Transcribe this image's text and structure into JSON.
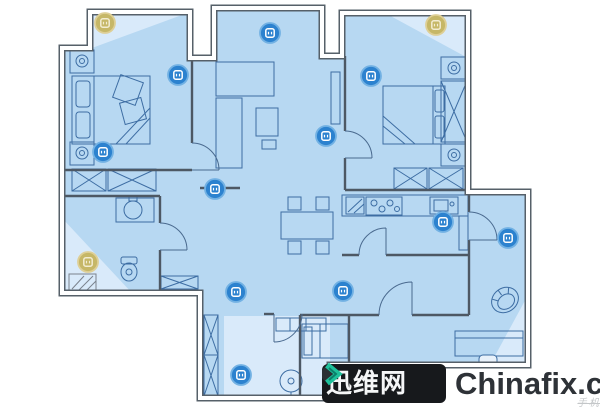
{
  "watermark": {
    "logo_text": "迅维网",
    "domain": "Chinafix.com",
    "tagline": "手机维修技改",
    "colors": {
      "box": "#17191c",
      "chevron": "#1ec19b",
      "chevron_dark": "#2a2f33",
      "logo_text_color": "#f5f6f7",
      "domain_text_color": "#2e3237"
    }
  },
  "floorplan": {
    "colors": {
      "floor_fill": "#b7d8f2",
      "floor_light_fill": "#d9eafa",
      "outer_wall": "#566069",
      "interior_wall": "#4d5864",
      "furniture_line": "#3d6da3",
      "marker_blue": "#2c82cf",
      "marker_blue_ring": "#72b1e3",
      "marker_yellow": "#c6b767",
      "marker_yellow_ring": "#decf96"
    },
    "rooms": [
      "balcony",
      "bedroom-1",
      "living-room",
      "bedroom-2",
      "bathroom",
      "kitchen",
      "dining-area",
      "hallway",
      "entry",
      "study"
    ],
    "markers": {
      "blue": {
        "icon": "smart-device-marker-icon",
        "fill": "#2c82cf",
        "ring": "#72b1e3",
        "glyph": "#ffffff",
        "items": [
          {
            "x": 178,
            "y": 75,
            "area": "bedroom-1"
          },
          {
            "x": 103,
            "y": 152,
            "area": "bedroom-1"
          },
          {
            "x": 270,
            "y": 33,
            "area": "living-room-bay"
          },
          {
            "x": 326,
            "y": 136,
            "area": "living-room"
          },
          {
            "x": 215,
            "y": 189,
            "area": "hallway"
          },
          {
            "x": 371,
            "y": 76,
            "area": "bedroom-2"
          },
          {
            "x": 443,
            "y": 222,
            "area": "kitchen"
          },
          {
            "x": 508,
            "y": 238,
            "area": "study"
          },
          {
            "x": 343,
            "y": 291,
            "area": "hallway"
          },
          {
            "x": 236,
            "y": 292,
            "area": "hallway"
          },
          {
            "x": 241,
            "y": 375,
            "area": "entry"
          }
        ]
      },
      "yellow": {
        "icon": "smart-device-marker-yellow-icon",
        "fill": "#c6b767",
        "ring": "#decf96",
        "glyph": "#f2ecd2",
        "items": [
          {
            "x": 105,
            "y": 23,
            "area": "balcony"
          },
          {
            "x": 436,
            "y": 25,
            "area": "bedroom-2"
          },
          {
            "x": 88,
            "y": 262,
            "area": "bathroom"
          }
        ]
      }
    }
  }
}
